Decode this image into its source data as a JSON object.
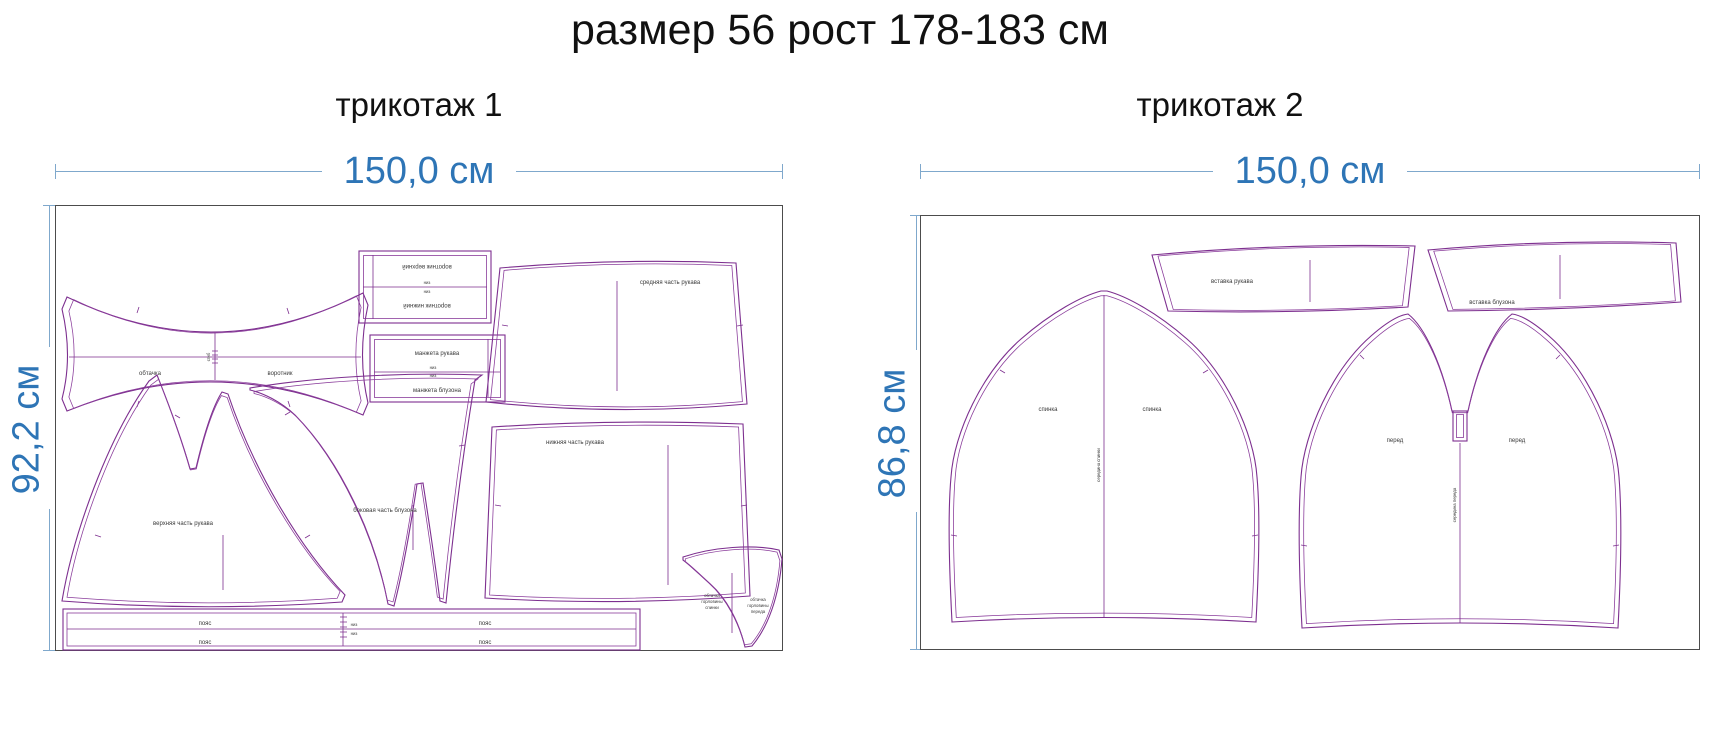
{
  "title": "размер 56 рост 178-183 см",
  "colors": {
    "dimension_blue": "#2e75b6",
    "pattern_purple": "#7d2f8f"
  },
  "panel1": {
    "subtitle": "трикотаж 1",
    "width_label": "150,0 см",
    "height_label": "92,2 см",
    "pieces": {
      "collar_left": "обтачка",
      "collar_right": "воротник",
      "collar_fold": "сгиб",
      "rect1_top": "воротник верхний",
      "rect1_fold_top": "низ",
      "rect1_fold_bottom": "низ",
      "rect1_bottom": "воротник нижний",
      "rect2_top": "манжета рукава",
      "rect2_fold_top": "низ",
      "rect2_fold_bottom": "низ",
      "rect2_bottom": "манжета блузона",
      "trapezoid_top": "средняя часть рукава",
      "sleeve_upper": "верхняя часть рукава",
      "side_piece": "боковая часть блузона",
      "sleeve_lower": "нижняя часть рукава",
      "belt_left": "пояс",
      "belt_right": "пояс",
      "belt_left2": "пояс",
      "belt_right2": "пояс",
      "belt_fold_top": "низ",
      "belt_fold_bottom": "низ",
      "facing_left": [
        "обтачка",
        "горловины",
        "спинки"
      ],
      "facing_right": [
        "обтачка",
        "горловины",
        "переда"
      ]
    }
  },
  "panel2": {
    "subtitle": "трикотаж 2",
    "width_label": "150,0 см",
    "height_label": "86,8 см",
    "pieces": {
      "insert_sleeve": "вставка рукава",
      "insert_body": "вставка блузона",
      "back_left": "спинка",
      "back_right": "спинка",
      "back_center": "середина спинки",
      "front_left": "перед",
      "front_right": "перед",
      "front_center": "середина переда"
    }
  }
}
